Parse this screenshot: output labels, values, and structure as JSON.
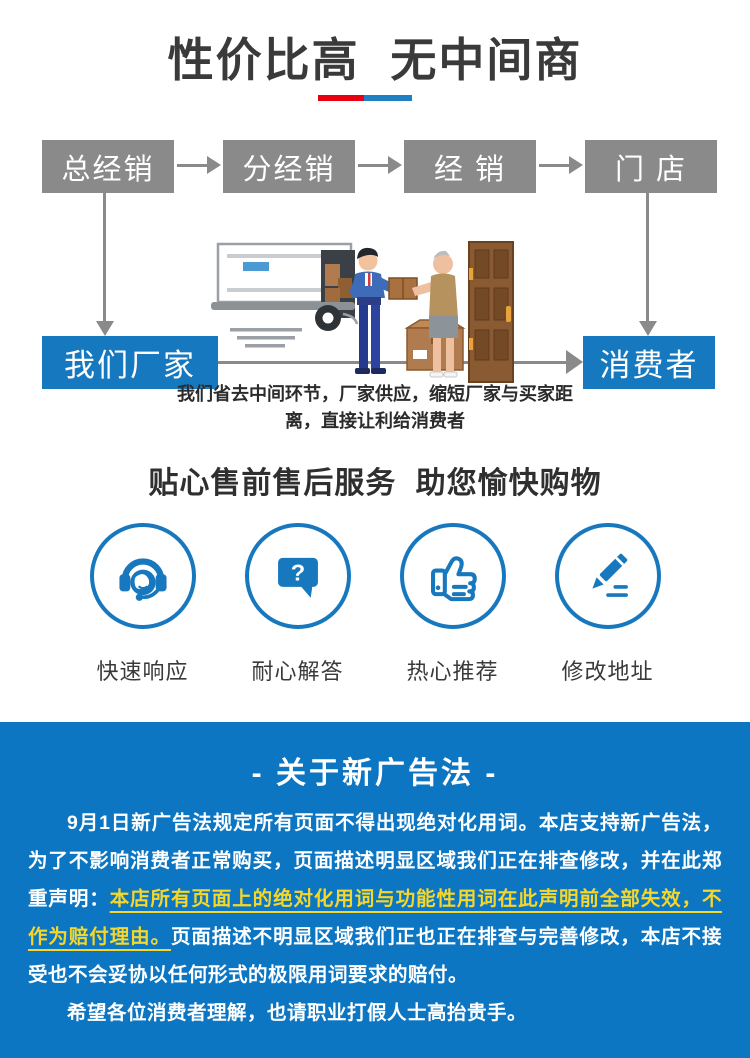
{
  "header": {
    "title": "性价比高 无中间商"
  },
  "flow": {
    "top_boxes": [
      "总经销",
      "分经销",
      "经 销",
      "门 店"
    ],
    "left_box": "我们厂家",
    "right_box": "消费者",
    "caption_line1": "我们省去中间环节，厂家供应，缩短厂家与买家距",
    "caption_line2": "离，直接让利给消费者"
  },
  "services": {
    "title": "贴心售前售后服务 助您愉快购物",
    "items": [
      {
        "icon": "headset-icon",
        "label": "快速响应"
      },
      {
        "icon": "question-bubble-icon",
        "label": "耐心解答"
      },
      {
        "icon": "thumb-up-icon",
        "label": "热心推荐"
      },
      {
        "icon": "pencil-icon",
        "label": "修改地址"
      }
    ],
    "glyphs": {
      "question_mark": "?"
    }
  },
  "notice": {
    "title": "- 关于新广告法 -",
    "p1_before": "9月1日新广告法规定所有页面不得出现绝对化用词。本店支持新广告法，为了不影响消费者正常购买，页面描述明显区域我们正在排查修改，并在此郑重声明：",
    "p1_highlight": "本店所有页面上的绝对化用词与功能性用词在此声明前全部失效，不作为赔付理由。",
    "p1_after": "页面描述不明显区域我们正也正在排查与完善修改，本店不接受也不会妥协以任何形式的极限用词要求的赔付。",
    "p2": "希望各位消费者理解，也请职业打假人士高抬贵手。"
  },
  "colors": {
    "accent_blue": "#1878be",
    "section_blue": "#0c76c3",
    "box_gray": "#8a8a8a",
    "box_blue": "#1678be",
    "underline_red": "#e60012",
    "underline_blue": "#1f80c4",
    "highlight_yellow": "#f5d62a",
    "title_text": "#3a3a3a"
  }
}
